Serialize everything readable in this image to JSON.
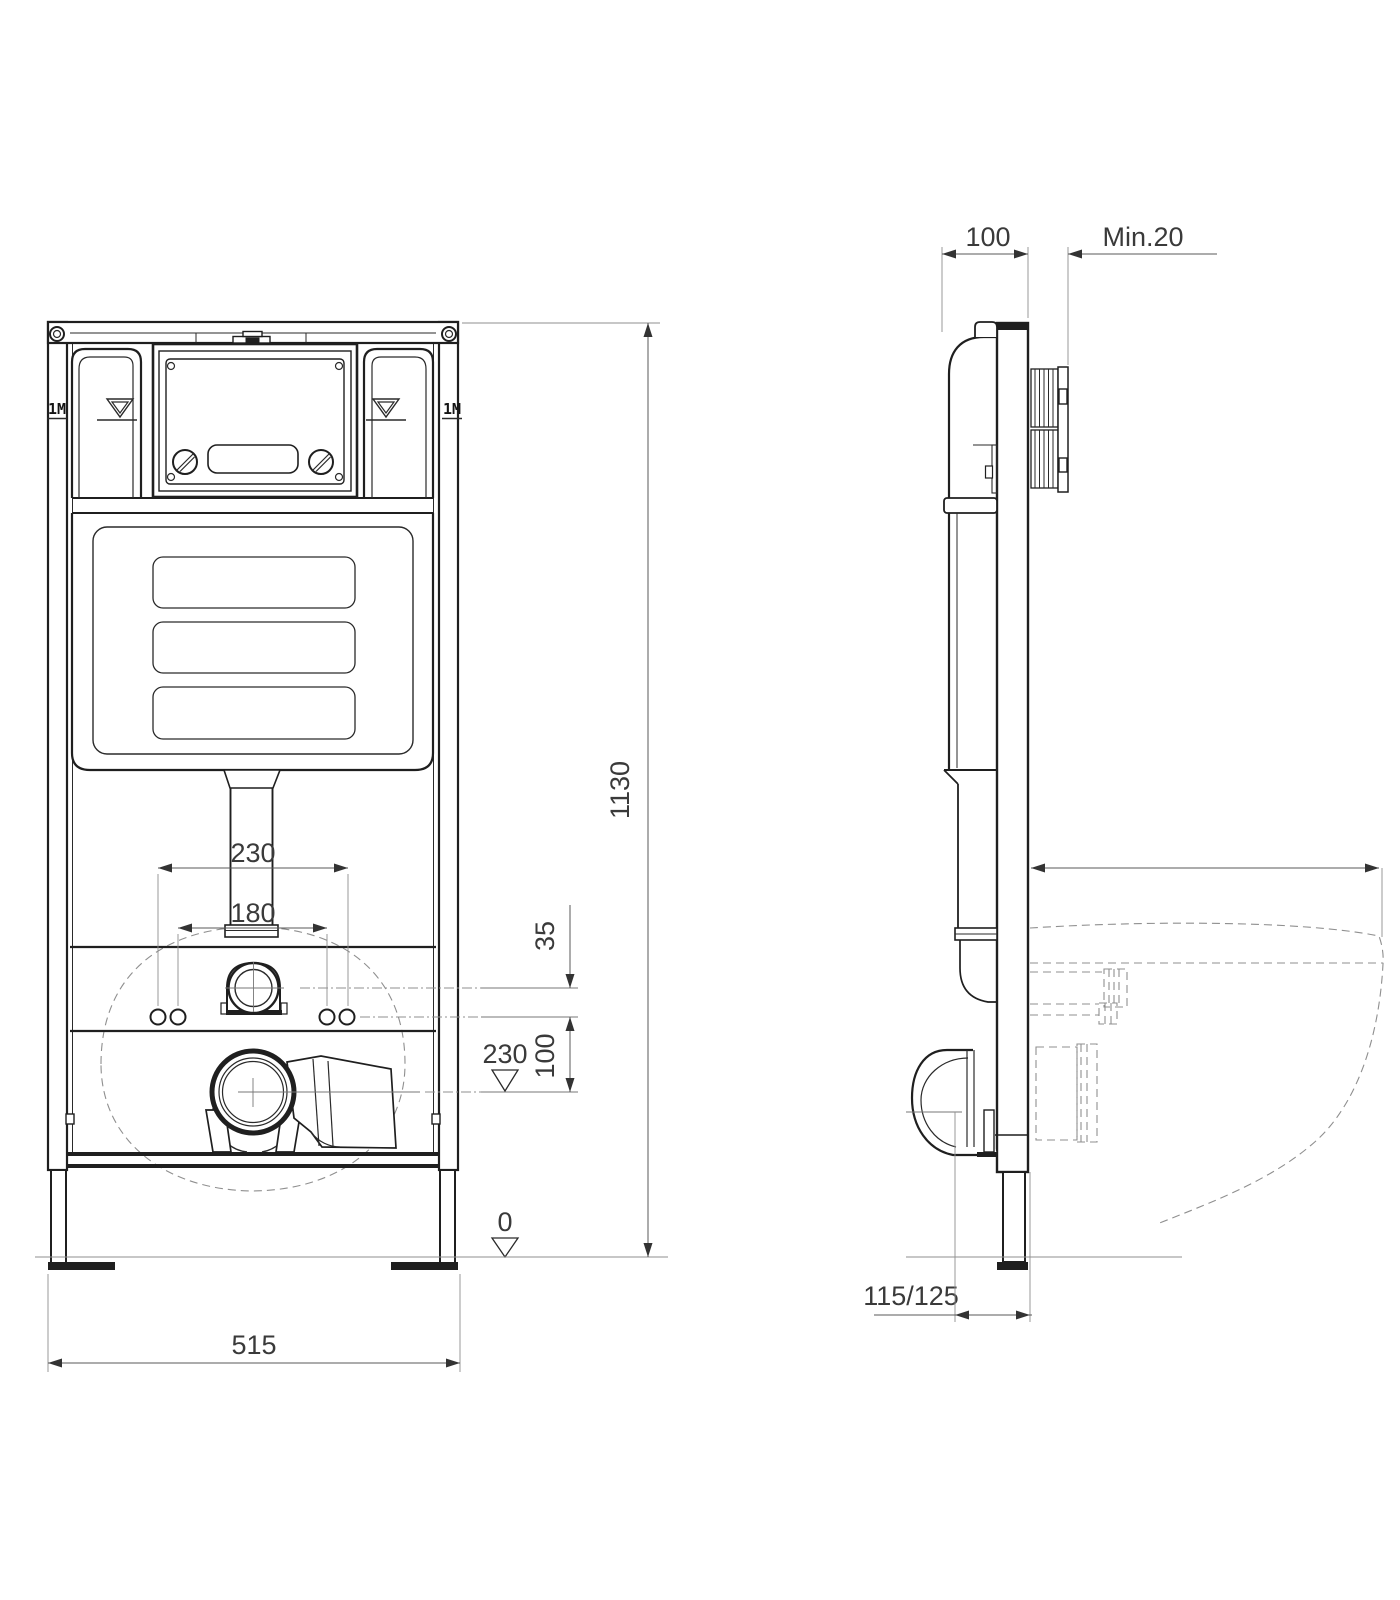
{
  "drawing": {
    "kind": "wall-mounted WC installation frame, dimensioned technical drawing, front and side view",
    "front_view": {
      "frame_marker_left": "1M",
      "frame_marker_right": "1M",
      "dim_bolt_spacing_outer": "230",
      "dim_bolt_spacing_inner": "180",
      "dim_frame_width": "515",
      "dim_frame_height": "1130",
      "dim_pipe_to_bolts": "35",
      "dim_bolts_to_drain": "100",
      "level_drain_height": "230",
      "level_floor": "0"
    },
    "side_view": {
      "dim_frame_depth": "100",
      "dim_wall_clearance": "Min.20",
      "dim_drain_pipe": "115/125"
    },
    "symbols": {
      "water_level_icon": "nested down-pointing triangle with underline",
      "datum_level_icon": "open down-pointing triangle"
    },
    "colors": {
      "background": "#ffffff",
      "object_line": "#1f1f1f",
      "dimension_line": "#5a5a5a",
      "hidden_line": "#8f8f8f"
    }
  }
}
